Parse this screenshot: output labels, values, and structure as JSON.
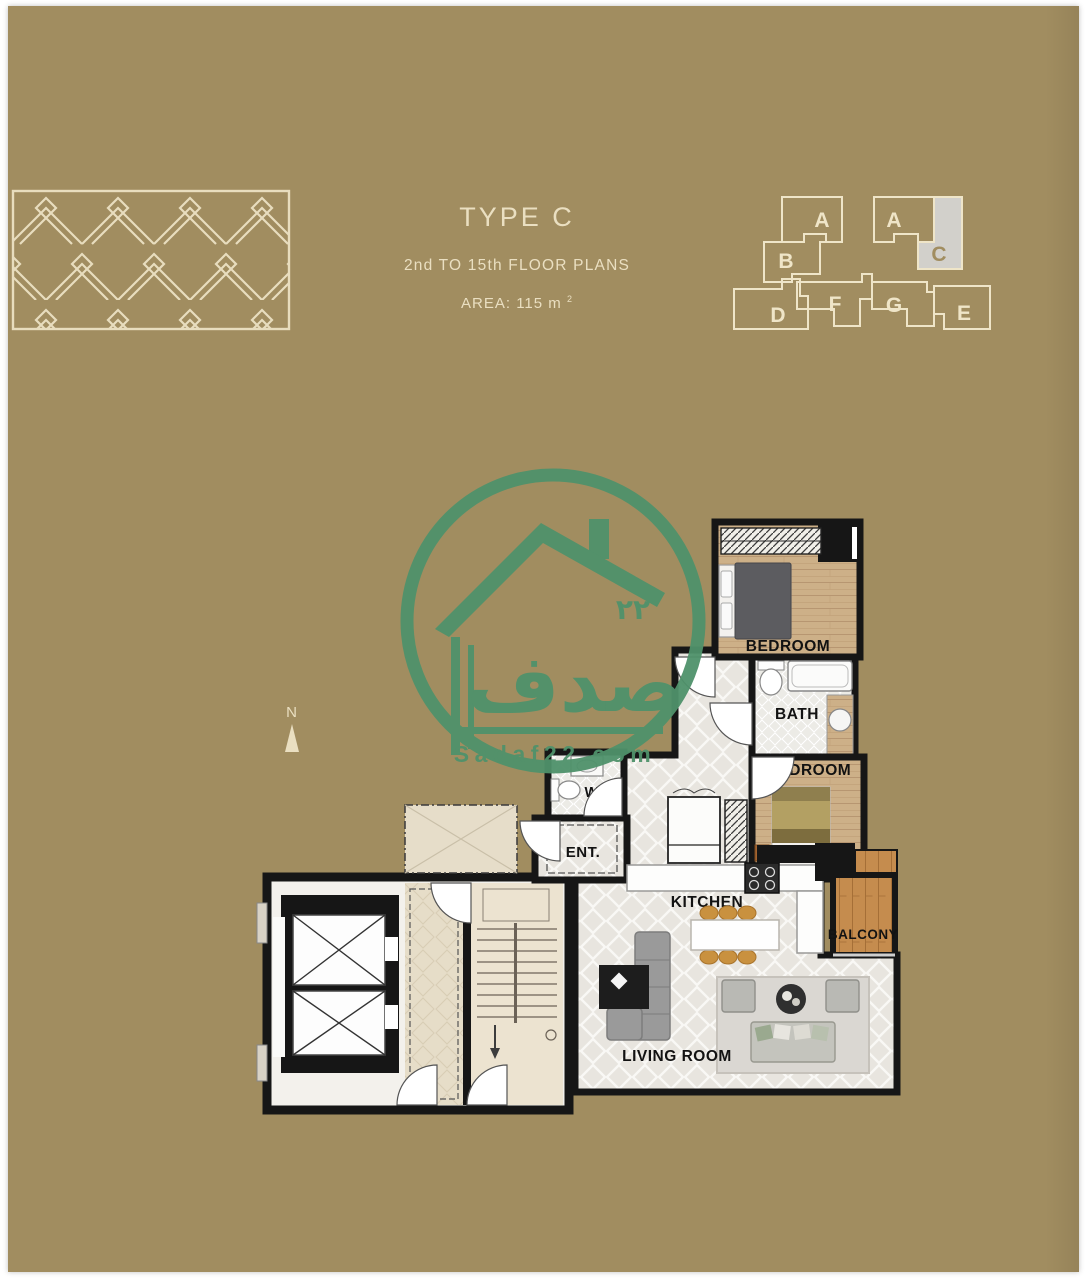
{
  "colors": {
    "background": "#a18d60",
    "frame": "#ffffff",
    "cream": "#eadfc1",
    "watermark_green": "#4f926b",
    "wall": "#161616",
    "keyplan_highlight": "#d2d0cb"
  },
  "header": {
    "title": "TYPE C",
    "subtitle": "2nd TO 15th FLOOR PLANS",
    "area_value": "AREA: 115 m",
    "area_sup": "2"
  },
  "compass": {
    "n": "N"
  },
  "key_plan": {
    "highlighted_unit": "C",
    "units": [
      {
        "label": "A"
      },
      {
        "label": "B"
      },
      {
        "label": "D"
      },
      {
        "label": "F"
      },
      {
        "label": "G"
      },
      {
        "label": "E"
      },
      {
        "label": "A"
      },
      {
        "label": "C"
      }
    ]
  },
  "watermark": {
    "arabic": "صدف",
    "number": "٢٢",
    "site": "Sadaf22.com"
  },
  "plan": {
    "rooms": [
      {
        "label": "BEDROOM"
      },
      {
        "label": "BATH"
      },
      {
        "label": "BEDROOM"
      },
      {
        "label": "W.C"
      },
      {
        "label": "ENT."
      },
      {
        "label": "KITCHEN"
      },
      {
        "label": "BALCONY"
      },
      {
        "label": "LIVING ROOM"
      }
    ]
  }
}
